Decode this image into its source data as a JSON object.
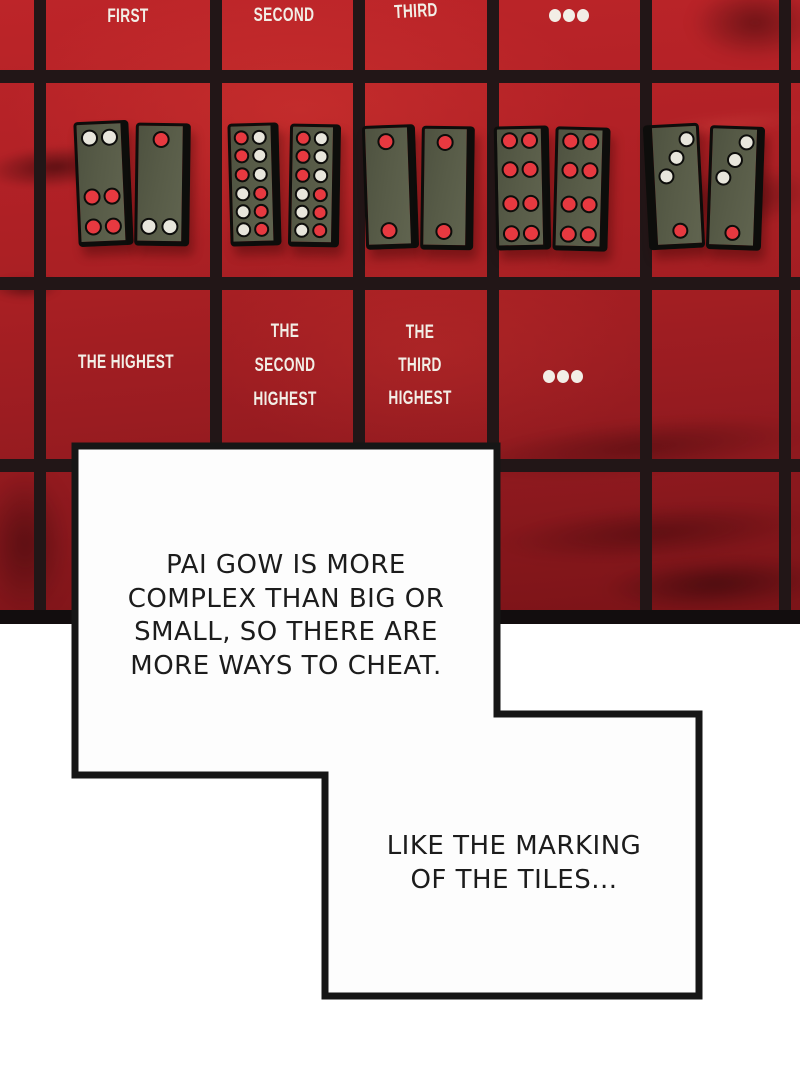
{
  "colors": {
    "table_red_top": "#bd2529",
    "table_red_bottom": "#7a1317",
    "grid_line": "#221617",
    "bottom_band": "#120d0e",
    "tile_face": "#575b47",
    "tile_border": "#0d0d0b",
    "pip_red": "#e73940",
    "pip_white": "#e8e6dc",
    "label_white": "#f2eee6",
    "bubble_fill": "#fdfdfd",
    "bubble_border": "#161616",
    "bubble_text": "#1c1c1c"
  },
  "grid": {
    "v_lines": [
      34,
      210,
      353,
      487,
      640,
      779
    ],
    "v_width": 12,
    "h_lines": [
      70,
      277,
      459
    ],
    "h_height": 13,
    "band_top": 610,
    "band_height": 14
  },
  "labels": {
    "row1": [
      {
        "kind": "text",
        "lines": [
          "FIRST"
        ],
        "cx": 128,
        "cy": 17,
        "rot": 0
      },
      {
        "kind": "text",
        "lines": [
          "SECOND"
        ],
        "cx": 284,
        "cy": 16,
        "rot": 0
      },
      {
        "kind": "text",
        "lines": [
          "THIRD"
        ],
        "cx": 416,
        "cy": 12,
        "rot": -3
      },
      {
        "kind": "dots",
        "cx": 569,
        "cy": 16
      }
    ],
    "row2": [
      {
        "kind": "text",
        "lines": [
          "THE HIGHEST"
        ],
        "cx": 126,
        "cy": 363,
        "rot": 0
      },
      {
        "kind": "text",
        "lines": [
          "THE",
          "SECOND",
          "HIGHEST"
        ],
        "cx": 285,
        "cy": 366,
        "lh": 34,
        "rot": 0
      },
      {
        "kind": "text",
        "lines": [
          "THE",
          "THIRD",
          "HIGHEST"
        ],
        "cx": 420,
        "cy": 365,
        "lh": 33,
        "rot": 0
      },
      {
        "kind": "dots",
        "cx": 563,
        "cy": 377
      }
    ]
  },
  "tile_pairs": [
    {
      "name": "gee-joon-pair",
      "rank": "first",
      "tiles": [
        {
          "name": "tile-2-4",
          "x": 76,
          "y": 121,
          "fw": 44,
          "fh": 117,
          "rot": -2.5,
          "edge": "right",
          "ps": 17,
          "pips": [
            [
              "w",
              4,
              5
            ],
            [
              "w",
              24,
              5
            ],
            [
              "r",
              4,
              64
            ],
            [
              "r",
              24,
              64
            ],
            [
              "r",
              4,
              94
            ],
            [
              "r",
              24,
              94
            ]
          ]
        },
        {
          "name": "tile-1-2",
          "x": 135,
          "y": 123,
          "fw": 44,
          "fh": 115,
          "rot": 0.8,
          "edge": "right",
          "ps": 17,
          "pips": [
            [
              "r",
              14,
              5
            ],
            [
              "w",
              3,
              92
            ],
            [
              "w",
              24,
              92
            ]
          ]
        }
      ]
    },
    {
      "name": "teen-pair",
      "rank": "second",
      "tiles": [
        {
          "name": "tile-6-6",
          "x": 229,
          "y": 123,
          "fw": 40,
          "fh": 115,
          "rot": -1.5,
          "edge": "right",
          "ps": 15,
          "pips": [
            [
              "r",
              3,
              4
            ],
            [
              "w",
              21,
              4
            ],
            [
              "r",
              3,
              22
            ],
            [
              "w",
              21,
              22
            ],
            [
              "r",
              3,
              41
            ],
            [
              "w",
              21,
              41
            ],
            [
              "w",
              3,
              60
            ],
            [
              "r",
              21,
              60
            ],
            [
              "w",
              3,
              78
            ],
            [
              "r",
              21,
              78
            ],
            [
              "w",
              3,
              96
            ],
            [
              "r",
              21,
              96
            ]
          ]
        },
        {
          "name": "tile-6-6",
          "x": 289,
          "y": 124,
          "fw": 40,
          "fh": 115,
          "rot": 1,
          "edge": "right",
          "ps": 15,
          "pips": [
            [
              "r",
              3,
              4
            ],
            [
              "w",
              21,
              4
            ],
            [
              "r",
              3,
              22
            ],
            [
              "w",
              21,
              22
            ],
            [
              "r",
              3,
              41
            ],
            [
              "w",
              21,
              41
            ],
            [
              "w",
              3,
              60
            ],
            [
              "r",
              21,
              60
            ],
            [
              "w",
              3,
              78
            ],
            [
              "r",
              21,
              78
            ],
            [
              "w",
              3,
              96
            ],
            [
              "r",
              21,
              96
            ]
          ]
        }
      ]
    },
    {
      "name": "day-pair",
      "rank": "third",
      "tiles": [
        {
          "name": "tile-1-1",
          "x": 364,
          "y": 125,
          "fw": 42,
          "fh": 116,
          "rot": -2,
          "edge": "right",
          "ps": 17,
          "pips": [
            [
              "r",
              12,
              5
            ],
            [
              "r",
              12,
              94
            ]
          ]
        },
        {
          "name": "tile-1-1",
          "x": 421,
          "y": 126,
          "fw": 42,
          "fh": 116,
          "rot": 0.8,
          "edge": "right",
          "ps": 17,
          "pips": [
            [
              "r",
              12,
              5
            ],
            [
              "r",
              12,
              94
            ]
          ]
        }
      ]
    },
    {
      "name": "red-eight-pair",
      "rank": "fourth",
      "tiles": [
        {
          "name": "tile-4-4",
          "x": 495,
          "y": 126,
          "fw": 44,
          "fh": 116,
          "rot": -1.2,
          "edge": "right",
          "ps": 17,
          "pips": [
            [
              "r",
              4,
              3
            ],
            [
              "r",
              24,
              3
            ],
            [
              "r",
              4,
              32
            ],
            [
              "r",
              24,
              32
            ],
            [
              "r",
              4,
              66
            ],
            [
              "r",
              24,
              66
            ],
            [
              "r",
              4,
              96
            ],
            [
              "r",
              24,
              96
            ]
          ]
        },
        {
          "name": "tile-4-4",
          "x": 554,
          "y": 127,
          "fw": 44,
          "fh": 116,
          "rot": 1.5,
          "edge": "right",
          "ps": 17,
          "pips": [
            [
              "r",
              4,
              3
            ],
            [
              "r",
              24,
              3
            ],
            [
              "r",
              4,
              32
            ],
            [
              "r",
              24,
              32
            ],
            [
              "r",
              4,
              66
            ],
            [
              "r",
              24,
              66
            ],
            [
              "r",
              4,
              96
            ],
            [
              "r",
              24,
              96
            ]
          ]
        }
      ]
    },
    {
      "name": "gor-pair",
      "rank": "fifth",
      "tiles": [
        {
          "name": "tile-1-3",
          "x": 646,
          "y": 124,
          "fw": 44,
          "fh": 117,
          "rot": -3,
          "edge": "left",
          "ps": 16,
          "pips": [
            [
              "w",
              26,
              5
            ],
            [
              "w",
              15,
              23
            ],
            [
              "w",
              4,
              41
            ],
            [
              "r",
              15,
              96
            ]
          ]
        },
        {
          "name": "tile-1-3",
          "x": 708,
          "y": 126,
          "fw": 44,
          "fh": 116,
          "rot": 2,
          "edge": "right",
          "ps": 16,
          "pips": [
            [
              "w",
              26,
              5
            ],
            [
              "w",
              15,
              23
            ],
            [
              "w",
              4,
              41
            ],
            [
              "r",
              15,
              96
            ]
          ]
        }
      ]
    }
  ],
  "bubbles": [
    {
      "name": "speech-bubble-1",
      "lines": [
        "PAI GOW IS MORE",
        "COMPLEX THAN BIG OR",
        "SMALL, SO THERE ARE",
        "MORE WAYS TO CHEAT."
      ]
    },
    {
      "name": "speech-bubble-2",
      "lines": [
        "LIKE THE MARKING",
        "OF THE TILES..."
      ]
    }
  ]
}
